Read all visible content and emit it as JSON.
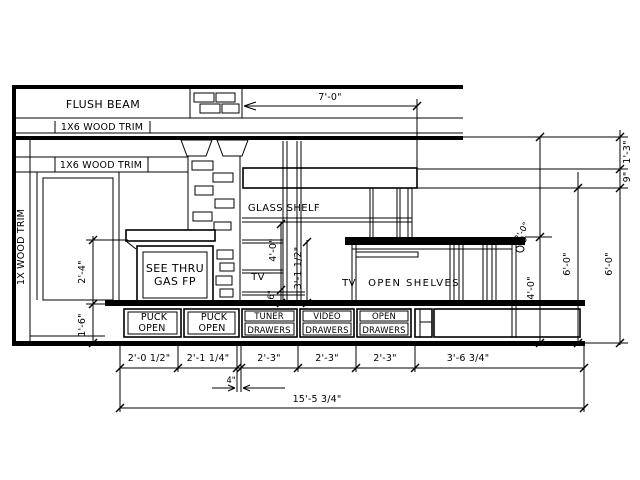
{
  "drawing": {
    "labels": {
      "flush_beam": "FLUSH BEAM",
      "trim_top": "1X6 WOOD TRIM",
      "trim_mid": "1X6 WOOD TRIM",
      "trim_left": "1X WOOD TRIM",
      "glass_shelf": "GLASS SHELF",
      "fp_line1": "SEE THRU",
      "fp_line2": "GAS FP",
      "tv_niche": "TV",
      "tv_console": "TV",
      "open_shelves": "OPEN SHELVES"
    },
    "cabinets": [
      {
        "top": "PUCK",
        "bottom": "OPEN"
      },
      {
        "top": "PUCK",
        "bottom": "OPEN"
      },
      {
        "top": "TUNER",
        "bottom": "DRAWERS"
      },
      {
        "top": "VIDEO",
        "bottom": "DRAWERS"
      },
      {
        "top": "OPEN",
        "bottom": "DRAWERS"
      }
    ],
    "dims": {
      "top_width": "7'-0\"",
      "beam_to_soffit": "1'-3\"",
      "soffit_height": "9\"",
      "console_height": "4'-0\"",
      "unit_height_a": "6'-0\"",
      "unit_height_b": "6'-0\"",
      "counter_return": "2'-0\"",
      "niche_height": "4'-0\"",
      "niche_inner": "3'-1 1/2\"",
      "niche_small": "6\"",
      "mantel_above_bench": "2'-4\"",
      "bench_height": "1'-6\"",
      "bay_widths": [
        "2'-0 1/2\"",
        "2'-1 1/4\"",
        "2'-3\"",
        "2'-3\"",
        "2'-3\"",
        "3'-6 3/4\""
      ],
      "post_width": "4\"",
      "overall_width": "15'-5 3/4\""
    }
  }
}
